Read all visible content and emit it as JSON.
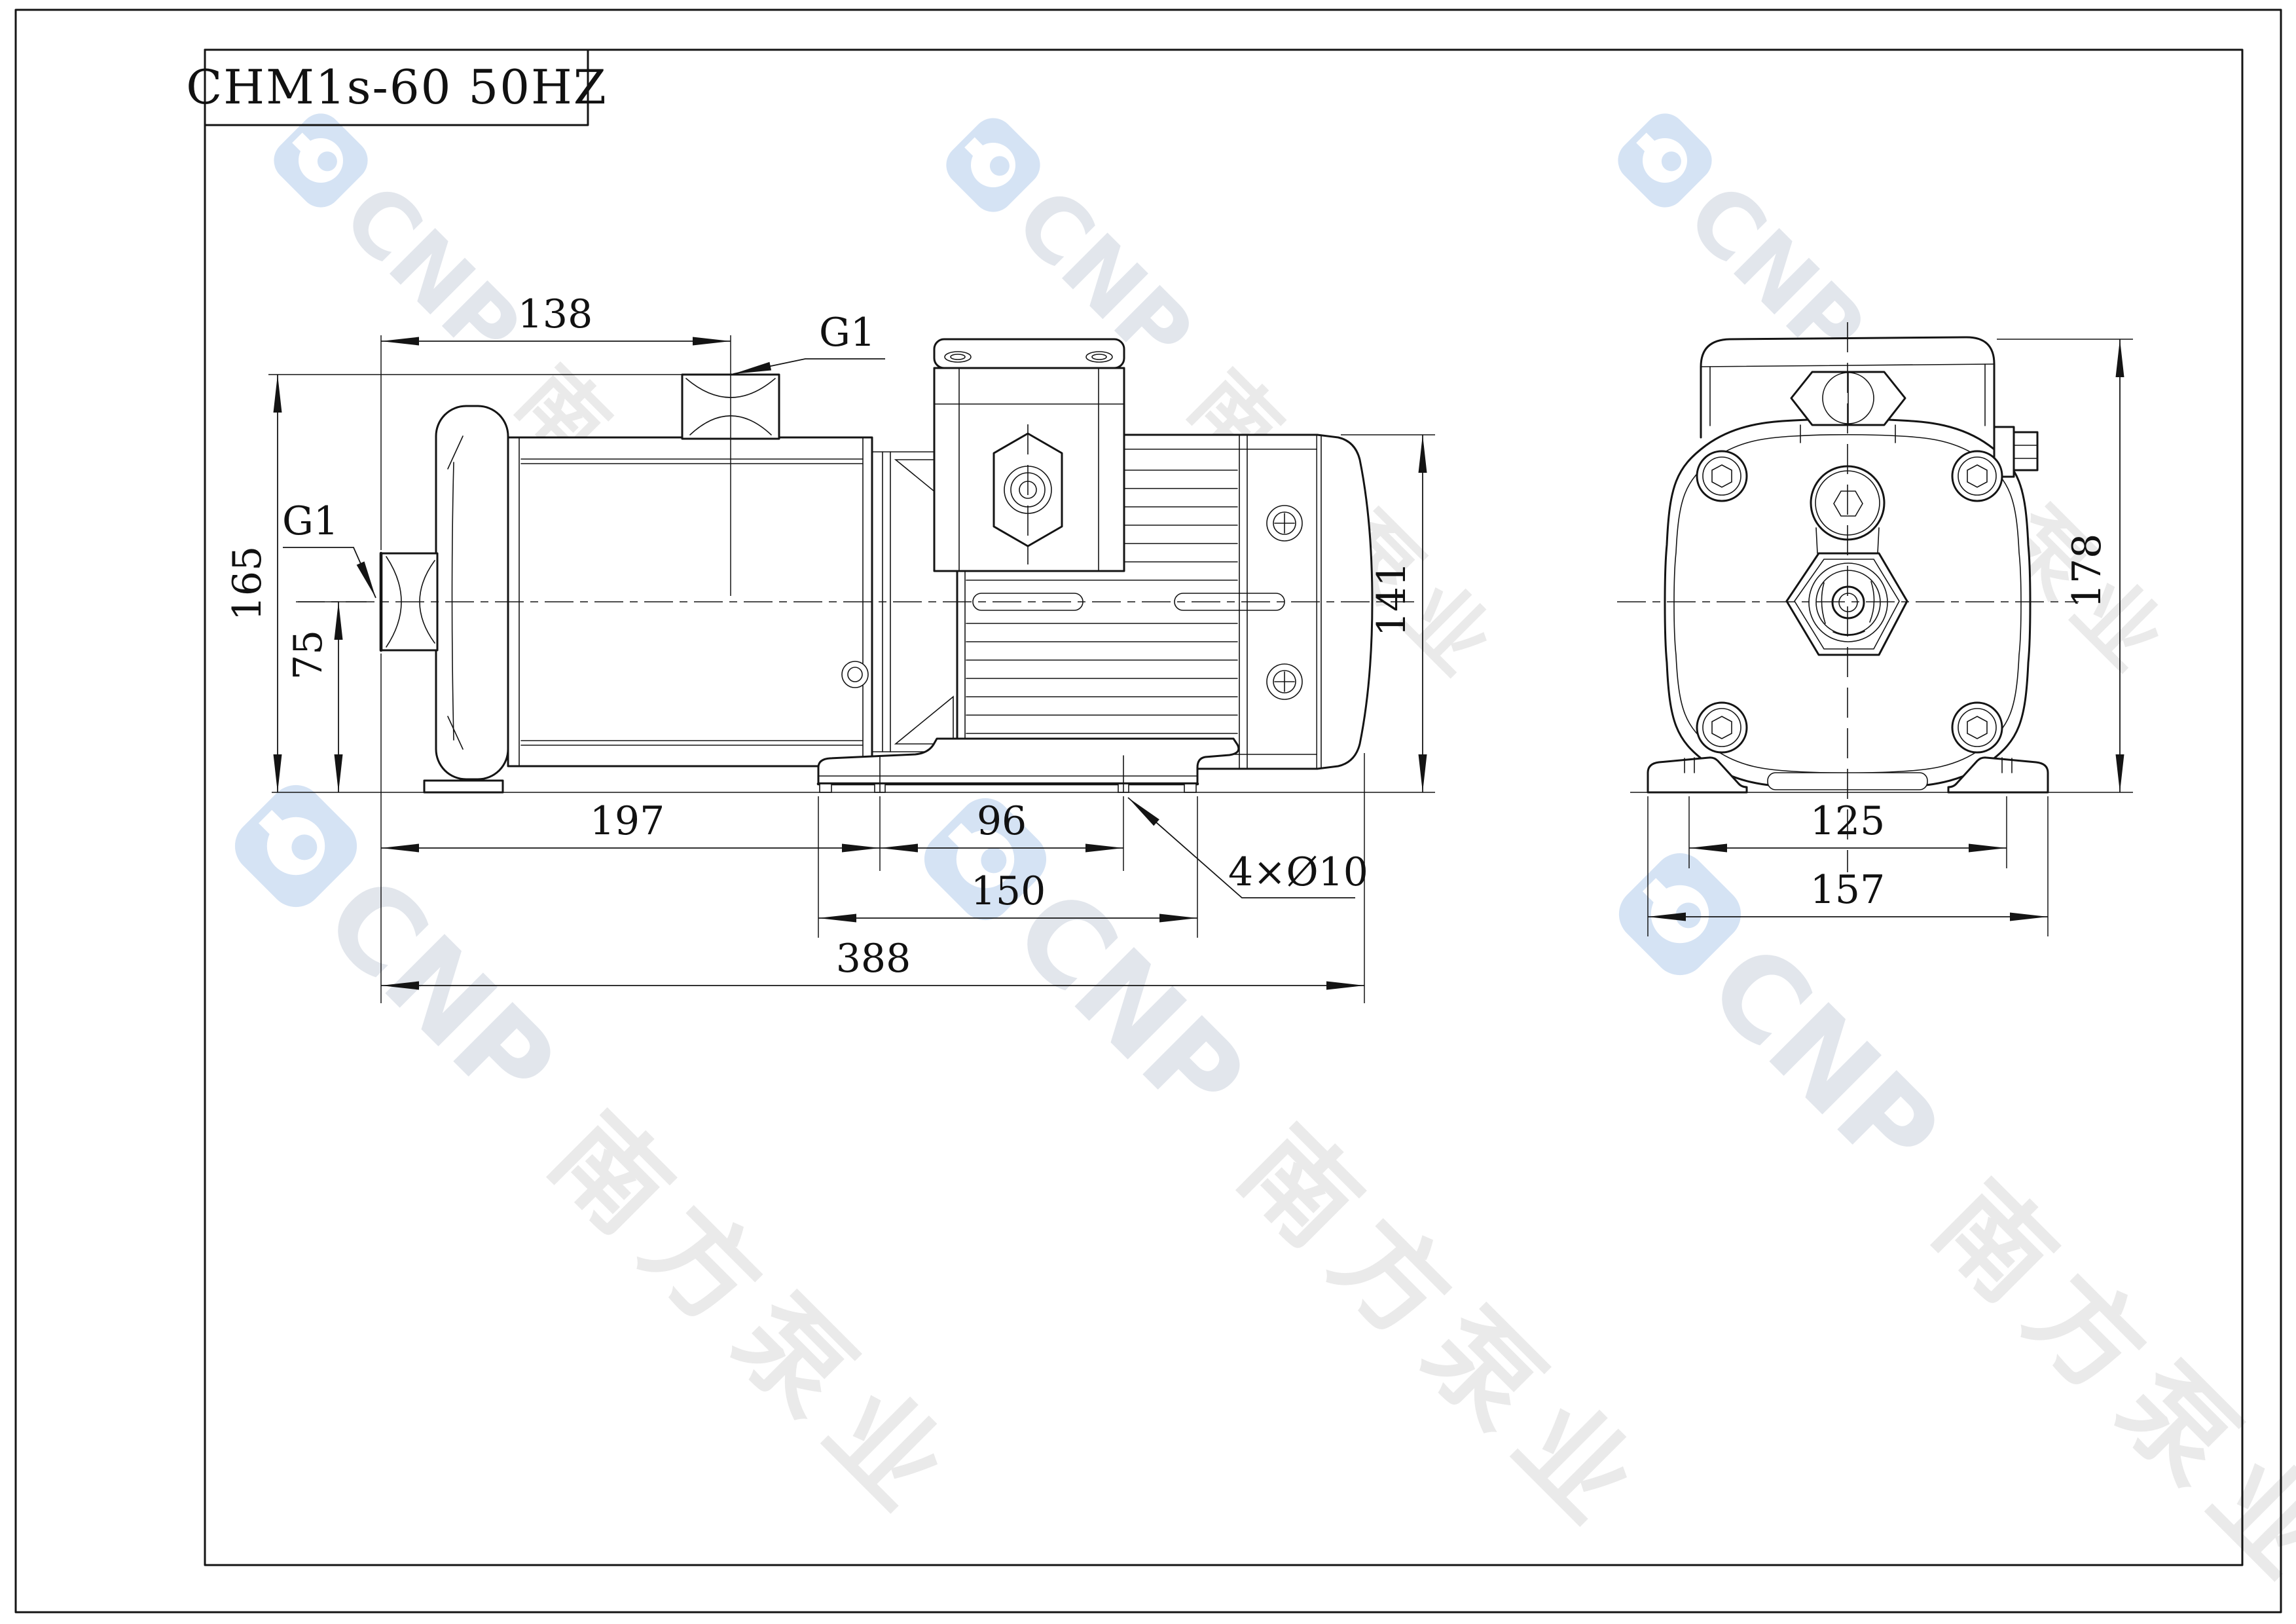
{
  "title_block": {
    "model": "CHM1s-60 50HZ"
  },
  "watermark": {
    "brand": "CNP",
    "cjk": "南方泵业"
  },
  "colors": {
    "line": "#141414",
    "watermark_logo": "#d5e3f4",
    "watermark_brand": "#e2e6ec",
    "watermark_cjk": "#eaeaea"
  },
  "side_view": {
    "dim_port_offset": "138",
    "label_outlet": "G1",
    "label_inlet": "G1",
    "dim_outlet_height": "165",
    "dim_center_height": "75",
    "dim_port_to_foot": "197",
    "dim_foot_holes": "96",
    "dim_foot_length": "150",
    "dim_total_length": "388",
    "dim_motor_height": "141",
    "label_foot_holes": "4×Ø10"
  },
  "end_view": {
    "dim_total_height": "178",
    "dim_hole_span": "125",
    "dim_foot_width": "157"
  }
}
